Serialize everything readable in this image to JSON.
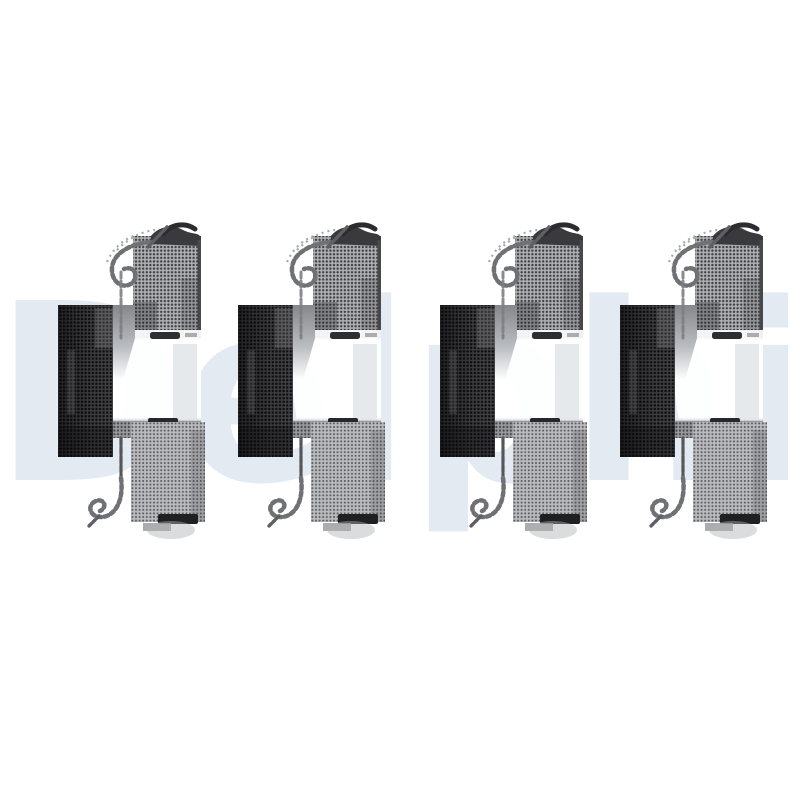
{
  "page": {
    "background": "#ffffff"
  },
  "watermark": {
    "text": "Delphi",
    "color": "#e4eaf2"
  },
  "product": {
    "description": "Four identical metal brake-pad fitting-kit clips arranged in a horizontal row",
    "item_count": 4,
    "palette": {
      "dark_metal": "#434347",
      "dark_dot": "#0f0f11",
      "mid_metal": "#aeafb2",
      "mid_dot": "#3c3d40",
      "light_metal": "#b9babd",
      "light_dot": "#5a5b5f",
      "band_metal": "#98999d",
      "band_dot": "#45464a",
      "wire": "#707175",
      "accent_dark": "#202023"
    }
  }
}
